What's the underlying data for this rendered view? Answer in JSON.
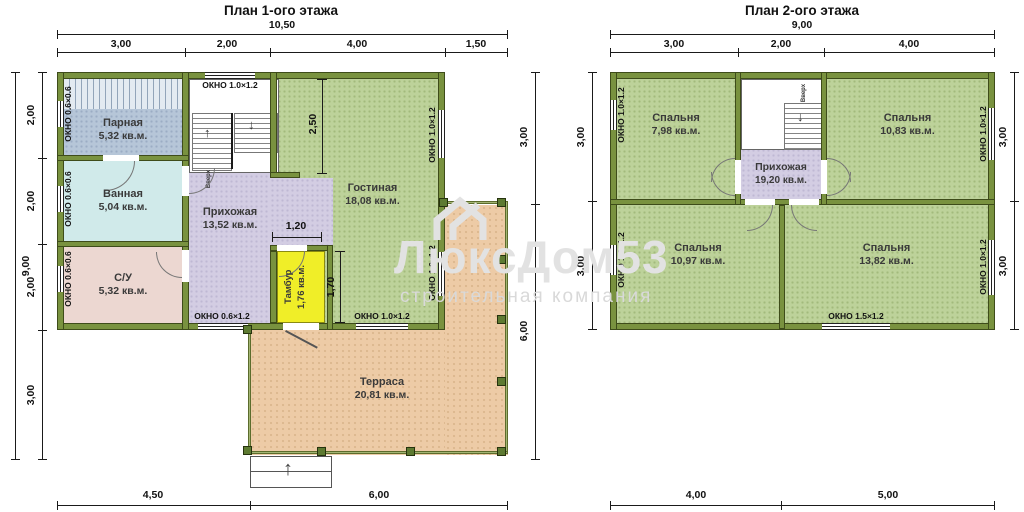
{
  "colors": {
    "wall": "#79923f",
    "room_green": "#bdd29a",
    "hallway": "#d3cde3",
    "bathroom": "#d0eaea",
    "sauna": "#b6c6d8",
    "wc": "#ecd7d1",
    "tambour": "#f0ee28",
    "terrace": "#edcba6"
  },
  "icons": {
    "up_arrow": "↑",
    "down_arrow": "↓"
  },
  "watermark": {
    "brand": "ЛюксДом53",
    "tagline": "строительная компания"
  },
  "floor1": {
    "title": "План 1-ого этажа",
    "dims": {
      "top_total": "10,50",
      "top_segments": [
        "3,00",
        "2,00",
        "4,00",
        "1,50"
      ],
      "left_total": "9,00",
      "left_segments": [
        "2,00",
        "2,00",
        "2,00",
        "3,00"
      ],
      "right_segments": [
        "3,00",
        "6,00"
      ],
      "bottom_segments": [
        "4,50",
        "6,00"
      ],
      "interior": {
        "livingroom_depth": "2,50",
        "hall_opening": "1,20",
        "tambour_depth": "1,70"
      }
    },
    "rooms": {
      "parnaya": {
        "name": "Парная",
        "area": "5,32 кв.м."
      },
      "vannaya": {
        "name": "Ванная",
        "area": "5,04 кв.м."
      },
      "su": {
        "name": "С/У",
        "area": "5,32 кв.м."
      },
      "prihozhaya": {
        "name": "Прихожая",
        "area": "13,52 кв.м."
      },
      "gostinaya": {
        "name": "Гостиная",
        "area": "18,08 кв.м."
      },
      "tambur": {
        "name": "Тамбур",
        "area": "1,76 кв.м."
      },
      "terrasa": {
        "name": "Терраса",
        "area": "20,81 кв.м."
      }
    },
    "windows": {
      "w_1_0x1_2": "ОКНО 1.0×1.2",
      "w_0_6x0_6": "ОКНО 0.6×0.6",
      "w_0_6x1_2": "ОКНО 0.6×1.2"
    },
    "stairs_label": "Вверх"
  },
  "floor2": {
    "title": "План 2-ого этажа",
    "dims": {
      "top_total": "9,00",
      "top_segments": [
        "3,00",
        "2,00",
        "4,00"
      ],
      "left_segments": [
        "3,00",
        "3,00"
      ],
      "right_segments": [
        "3,00",
        "3,00"
      ],
      "bottom_segments": [
        "4,00",
        "5,00"
      ]
    },
    "rooms": {
      "bedroom_tl": {
        "name": "Спальня",
        "area": "7,98 кв.м."
      },
      "bedroom_tr": {
        "name": "Спальня",
        "area": "10,83 кв.м."
      },
      "bedroom_bl": {
        "name": "Спальня",
        "area": "10,97 кв.м."
      },
      "bedroom_br": {
        "name": "Спальня",
        "area": "13,82 кв.м."
      },
      "prihozhaya": {
        "name": "Прихожая",
        "area": "19,20 кв.м."
      }
    },
    "windows": {
      "w_1_0x1_2": "ОКНО 1.0×1.2",
      "w_1_5x1_2": "ОКНО 1.5×1.2"
    },
    "stairs_label": "Вверх"
  }
}
